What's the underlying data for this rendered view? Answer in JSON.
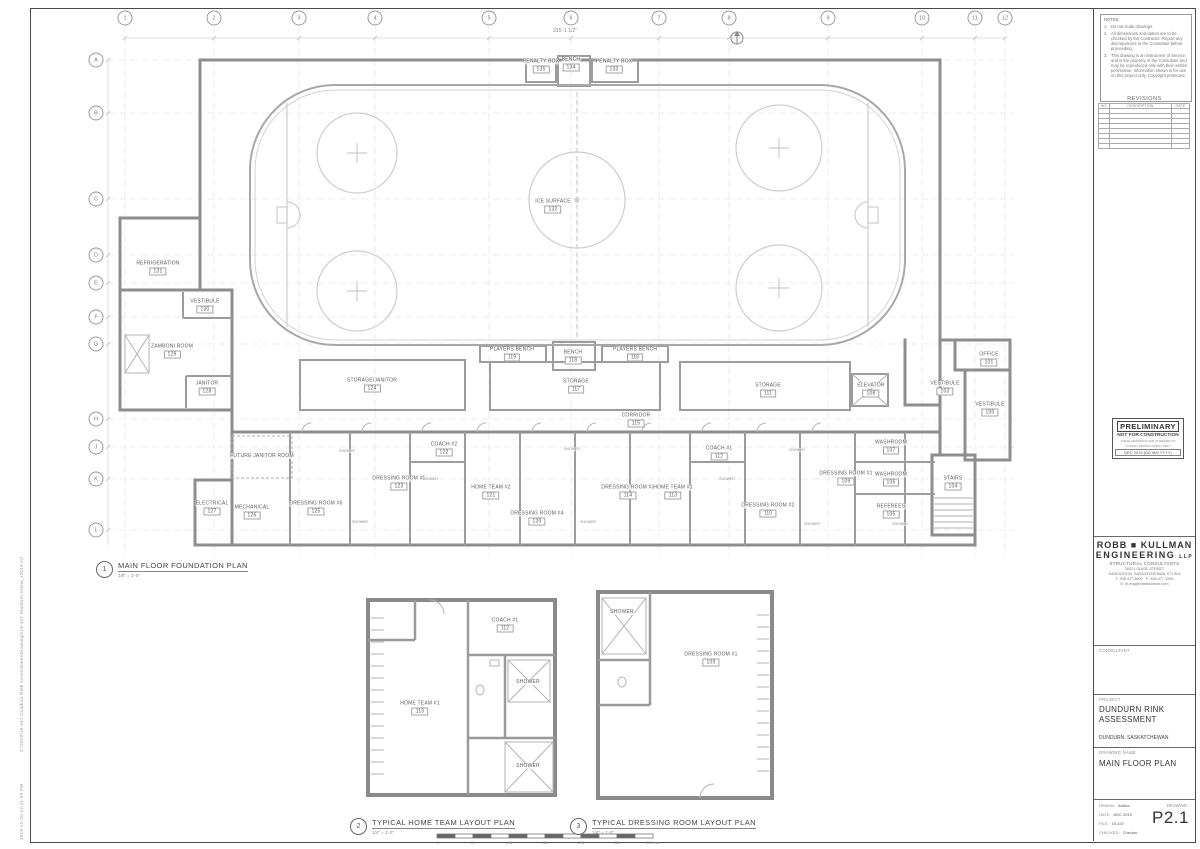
{
  "sheet": {
    "plot_stamp": "2019-12-20 12:41:03 PM",
    "file_path": "Z:\\2019\\19-447 Dundurn Rink Assessment\\Drawings\\19-447 Dundurn Arena_r2019.rvt"
  },
  "notes": {
    "title": "NOTES:",
    "items": [
      "Do not scale drawings.",
      "All dimensions and datum are to be checked by the Contractor. Report any discrepancies to the Consultant before proceeding.",
      "This drawing is an instrument of Service and is the property of the Consultant and may be reproduced only with their written permission. Information shown is for use on this project only. Copyright protected."
    ]
  },
  "revisions": {
    "title": "REVISIONS",
    "columns": [
      "NO.",
      "DESCRIPTION",
      "DATE"
    ],
    "empty_rows": 8
  },
  "stamp": {
    "title": "PRELIMINARY",
    "subtitle": "NOT FOR CONSTRUCTION",
    "note1": "THESE DRAWINGS ARE INTENDED TO",
    "note2": "CONVEY DESIGN INTENT ONLY",
    "date_line": "DEC 2019    (DD MM YYYY)"
  },
  "firm": {
    "name1": "ROBB ■ KULLMAN",
    "name2": "ENGINEERING",
    "suffix": "LLP",
    "tagline": "STRUCTURAL  CONSULTANTS",
    "address1": "3022 LOUISE STREET",
    "address2": "SASKATOON, SASKATCHEWAN    S7J 3L8",
    "phone": "T: 306.477.3600",
    "fax": "F: 306.477.1995",
    "email": "E: rk.eng@robbkullman.com"
  },
  "consultant": {
    "label": "CONSULTANT"
  },
  "project": {
    "label": "PROJECT",
    "name1": "DUNDURN RINK",
    "name2": "ASSESSMENT",
    "location": "DUNDURN, SASKATCHEWAN"
  },
  "drawing": {
    "label": "DRAWING NAME",
    "name": "MAIN FLOOR PLAN"
  },
  "info": {
    "drawn_label": "DRAWN:",
    "drawn": "Author",
    "date_label": "DATE:",
    "date": "DEC 2019",
    "file_label": "FILE:",
    "file": "19-447",
    "checked_label": "CHECKED:",
    "checked": "Checker",
    "drawing_label": "DRAWING",
    "number": "P2.1"
  },
  "dims": {
    "overall_top": "215'-1 1/2\""
  },
  "grid": {
    "cols": [
      {
        "label": "1",
        "x": 125
      },
      {
        "label": "2",
        "x": 214
      },
      {
        "label": "3",
        "x": 299
      },
      {
        "label": "4",
        "x": 375
      },
      {
        "label": "5",
        "x": 489
      },
      {
        "label": "6",
        "x": 571
      },
      {
        "label": "7",
        "x": 659
      },
      {
        "label": "8",
        "x": 729
      },
      {
        "label": "9",
        "x": 828
      },
      {
        "label": "10",
        "x": 922
      },
      {
        "label": "11",
        "x": 975
      },
      {
        "label": "12",
        "x": 1005
      }
    ],
    "rows": [
      {
        "label": "A",
        "y": 60
      },
      {
        "label": "B",
        "y": 113
      },
      {
        "label": "C",
        "y": 199
      },
      {
        "label": "D",
        "y": 255
      },
      {
        "label": "E",
        "y": 283
      },
      {
        "label": "F",
        "y": 317
      },
      {
        "label": "G",
        "y": 344
      },
      {
        "label": "H",
        "y": 419
      },
      {
        "label": "J",
        "y": 447
      },
      {
        "label": "K",
        "y": 479
      },
      {
        "label": "L",
        "y": 530
      }
    ]
  },
  "plan_titles": [
    {
      "num": "1",
      "title": "MAIN FLOOR FOUNDATION PLAN",
      "scale": "1/8\" = 1'-0\"",
      "x": 96,
      "y": 561
    },
    {
      "num": "2",
      "title": "TYPICAL HOME TEAM LAYOUT PLAN",
      "scale": "1/4\" = 1'-0\"",
      "x": 350,
      "y": 818
    },
    {
      "num": "3",
      "title": "TYPICAL DRESSING ROOM LAYOUT PLAN",
      "scale": "1/4\" = 1'-0\"",
      "x": 570,
      "y": 818
    }
  ],
  "floor_plan": {
    "rooms": [
      {
        "name": "PENALTY BOX",
        "number": "135",
        "x": 541,
        "y": 66
      },
      {
        "name": "BENCH",
        "number": "134",
        "x": 571,
        "y": 64
      },
      {
        "name": "PENALTY BOX",
        "number": "133",
        "x": 614,
        "y": 66
      },
      {
        "name": "ICE SURFACE",
        "number": "132",
        "x": 553,
        "y": 206
      },
      {
        "name": "REFRIGERATION",
        "number": "131",
        "x": 158,
        "y": 268
      },
      {
        "name": "VESTIBULE",
        "number": "130",
        "x": 205,
        "y": 306
      },
      {
        "name": "ZAMBONI ROOM",
        "number": "129",
        "x": 172,
        "y": 351
      },
      {
        "name": "JANITOR",
        "number": "128",
        "x": 207,
        "y": 388
      },
      {
        "name": "ELECTRICAL",
        "number": "127",
        "x": 212,
        "y": 508
      },
      {
        "name": "MECHANICAL",
        "number": "126",
        "x": 252,
        "y": 512
      },
      {
        "name": "DRESSING ROOM #6",
        "number": "125",
        "x": 316,
        "y": 508
      },
      {
        "name": "STORAGE/JANITOR",
        "number": "124",
        "x": 372,
        "y": 385
      },
      {
        "name": "DRESSING ROOM #5",
        "number": "123",
        "x": 399,
        "y": 483
      },
      {
        "name": "COACH #2",
        "number": "122",
        "x": 444,
        "y": 449
      },
      {
        "name": "HOME TEAM #2",
        "number": "121",
        "x": 491,
        "y": 492
      },
      {
        "name": "DRESSING ROOM #4",
        "number": "120",
        "x": 537,
        "y": 518
      },
      {
        "name": "PLAYERS BENCH",
        "number": "119",
        "x": 512,
        "y": 354
      },
      {
        "name": "BENCH",
        "number": "118",
        "x": 573,
        "y": 357
      },
      {
        "name": "STORAGE",
        "number": "117",
        "x": 576,
        "y": 386
      },
      {
        "name": "PLAYERS BENCH",
        "number": "116",
        "x": 635,
        "y": 354
      },
      {
        "name": "CORRIDOR",
        "number": "115",
        "x": 636,
        "y": 420
      },
      {
        "name": "DRESSING ROOM #3",
        "number": "114",
        "x": 628,
        "y": 492
      },
      {
        "name": "HOME TEAM #1",
        "number": "113",
        "x": 673,
        "y": 492
      },
      {
        "name": "COACH #1",
        "number": "112",
        "x": 719,
        "y": 453
      },
      {
        "name": "STORAGE",
        "number": "111",
        "x": 768,
        "y": 390
      },
      {
        "name": "DRESSING ROOM #2",
        "number": "110",
        "x": 768,
        "y": 510
      },
      {
        "name": "DRESSING ROOM #1",
        "number": "109",
        "x": 846,
        "y": 478
      },
      {
        "name": "ELEVATOR",
        "number": "108",
        "x": 871,
        "y": 390
      },
      {
        "name": "WASHROOM",
        "number": "107",
        "x": 891,
        "y": 447
      },
      {
        "name": "WASHROOM",
        "number": "106",
        "x": 891,
        "y": 479
      },
      {
        "name": "REFEREES",
        "number": "105",
        "x": 891,
        "y": 511
      },
      {
        "name": "STAIRS",
        "number": "104",
        "x": 953,
        "y": 483
      },
      {
        "name": "VESTIBULE",
        "number": "103",
        "x": 945,
        "y": 388
      },
      {
        "name": "OFFICE",
        "number": "101",
        "x": 989,
        "y": 359
      },
      {
        "name": "VESTIBULE",
        "number": "100",
        "x": 990,
        "y": 409
      },
      {
        "name": "FUTURE JANITOR ROOM",
        "number": "",
        "x": 262,
        "y": 456
      }
    ],
    "fixture_labels": [
      {
        "name": "SHOWER",
        "x": 347,
        "y": 451
      },
      {
        "name": "SHOWER",
        "x": 360,
        "y": 522
      },
      {
        "name": "SHOWER",
        "x": 430,
        "y": 479
      },
      {
        "name": "SHOWER",
        "x": 572,
        "y": 449
      },
      {
        "name": "SHOWER",
        "x": 588,
        "y": 522
      },
      {
        "name": "SHOWER",
        "x": 727,
        "y": 479
      },
      {
        "name": "SHOWER",
        "x": 797,
        "y": 450
      },
      {
        "name": "SHOWER",
        "x": 812,
        "y": 524
      },
      {
        "name": "SHOWER",
        "x": 900,
        "y": 524
      }
    ]
  },
  "detail_home_team": {
    "rooms": [
      {
        "name": "COACH #1",
        "number": "112",
        "x": 505,
        "y": 625
      },
      {
        "name": "HOME TEAM #1",
        "number": "113",
        "x": 420,
        "y": 708
      },
      {
        "name": "SHOWER",
        "number": "",
        "x": 528,
        "y": 682
      },
      {
        "name": "SHOWER",
        "number": "",
        "x": 528,
        "y": 766
      }
    ]
  },
  "detail_dressing": {
    "rooms": [
      {
        "name": "DRESSING ROOM #1",
        "number": "109",
        "x": 711,
        "y": 659
      },
      {
        "name": "SHOWER",
        "number": "",
        "x": 622,
        "y": 612
      }
    ]
  },
  "scale_bar": {
    "labels": [
      "0",
      "50",
      "100",
      "150",
      "200",
      "250",
      "300 mm"
    ],
    "xs": [
      437,
      473,
      509,
      545,
      581,
      617,
      653
    ]
  }
}
